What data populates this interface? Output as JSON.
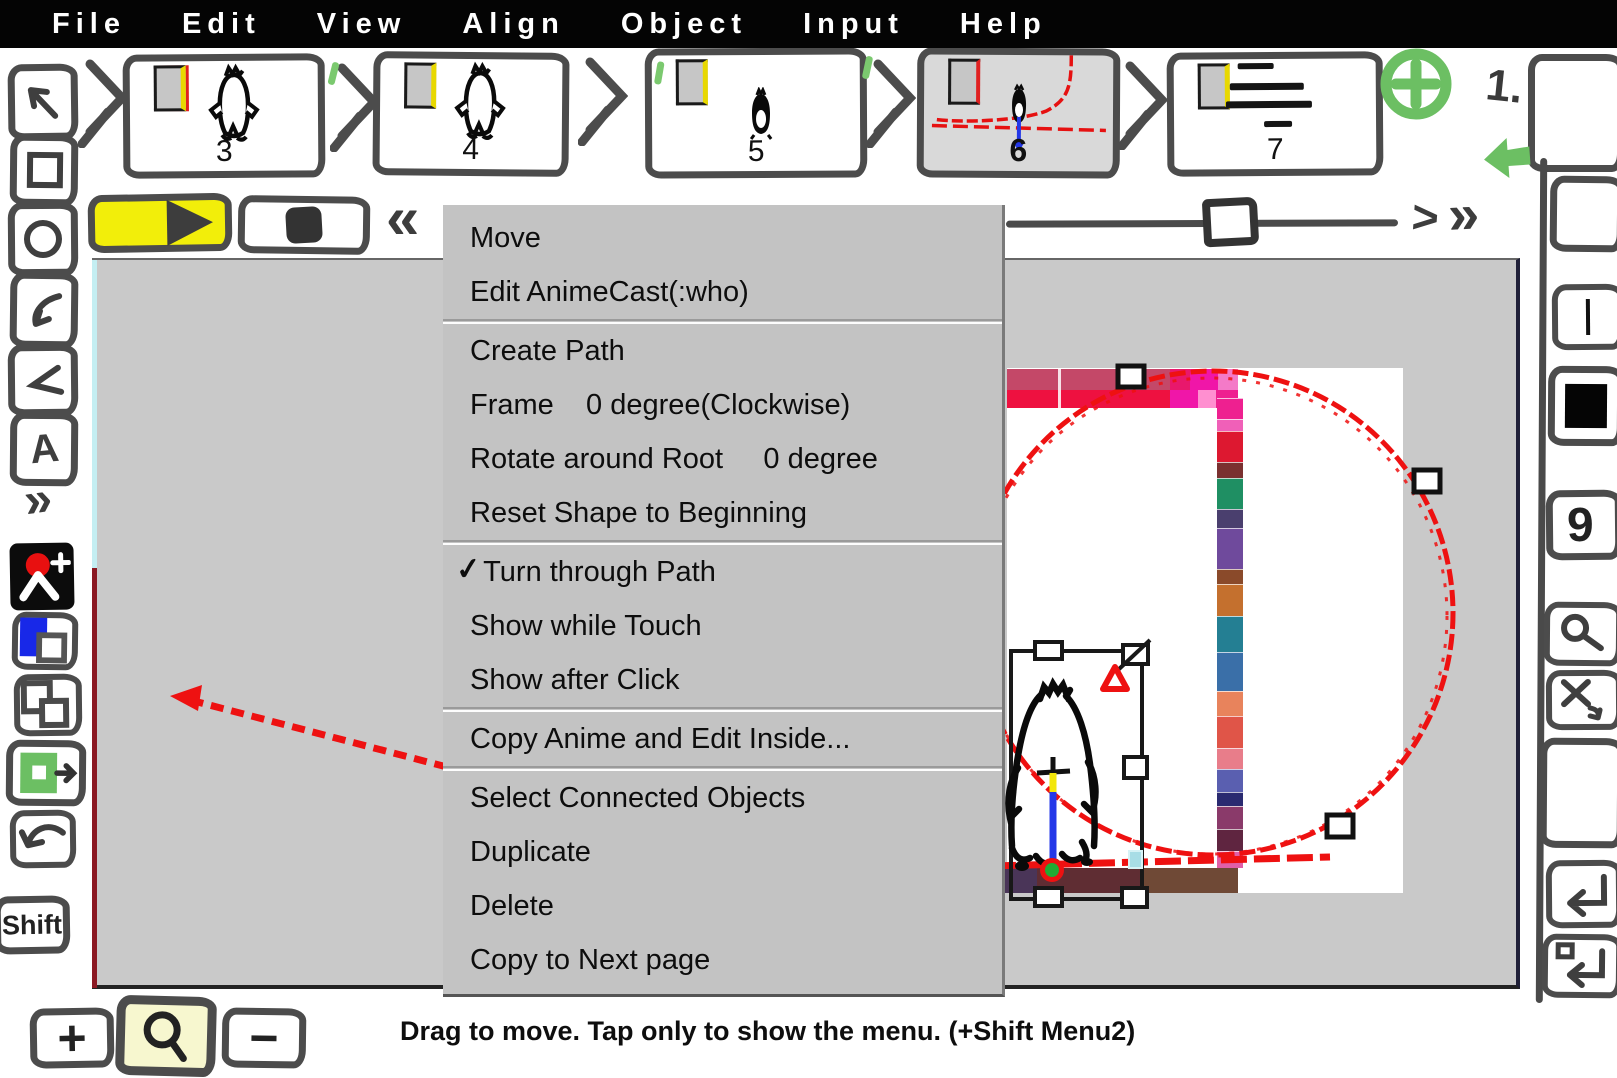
{
  "menubar": {
    "items": [
      {
        "label": "File"
      },
      {
        "label": "Edit"
      },
      {
        "label": "View"
      },
      {
        "label": "Align"
      },
      {
        "label": "Object"
      },
      {
        "label": "Input"
      },
      {
        "label": "Help"
      }
    ]
  },
  "filmstrip": {
    "frames": [
      {
        "label": "3"
      },
      {
        "label": "4"
      },
      {
        "label": "5"
      },
      {
        "label": "6"
      },
      {
        "label": "7"
      }
    ],
    "selected_frame": "6",
    "page_indicator": "1."
  },
  "context_menu": {
    "checkmark": "✓",
    "checked_item": "Turn through Path",
    "items": [
      {
        "label": "Move"
      },
      {
        "label": "Edit AnimeCast(:who)"
      },
      {
        "label": "Create Path"
      },
      {
        "label": "Frame    0 degree(Clockwise)"
      },
      {
        "label": "Rotate around Root     0 degree"
      },
      {
        "label": "Reset Shape to Beginning"
      },
      {
        "label": "Turn through Path"
      },
      {
        "label": "Show while Touch"
      },
      {
        "label": "Show after Click"
      },
      {
        "label": "Copy Anime and Edit Inside..."
      },
      {
        "label": "Select Connected Objects"
      },
      {
        "label": "Duplicate"
      },
      {
        "label": "Delete"
      },
      {
        "label": "Copy to Next page"
      }
    ]
  },
  "icons": {
    "back": "«",
    "forward": ">",
    "forward_fast": "»",
    "more": "»",
    "text_tool": "A",
    "zoom_in": "+",
    "zoom_out": "−"
  },
  "left_toolbar": {
    "shift_label": "Shift"
  },
  "right_toolbar": {
    "number_label": "9"
  },
  "status_bar": {
    "message": "Drag to move. Tap only to show the menu. (+Shift Menu2)"
  },
  "colors": {
    "path_red": "#ee1111",
    "play_yellow": "#f2ee0a",
    "accent_green": "#6cbf63",
    "anchor_blue": "#2438e8",
    "canvas_gray": "#c9c9c9",
    "menu_gray": "#c3c3c3",
    "pale_yellow_highlight": "#f7f7cf",
    "edge_cyan": "#c4eef2",
    "edge_dark_red": "#8b1822"
  }
}
